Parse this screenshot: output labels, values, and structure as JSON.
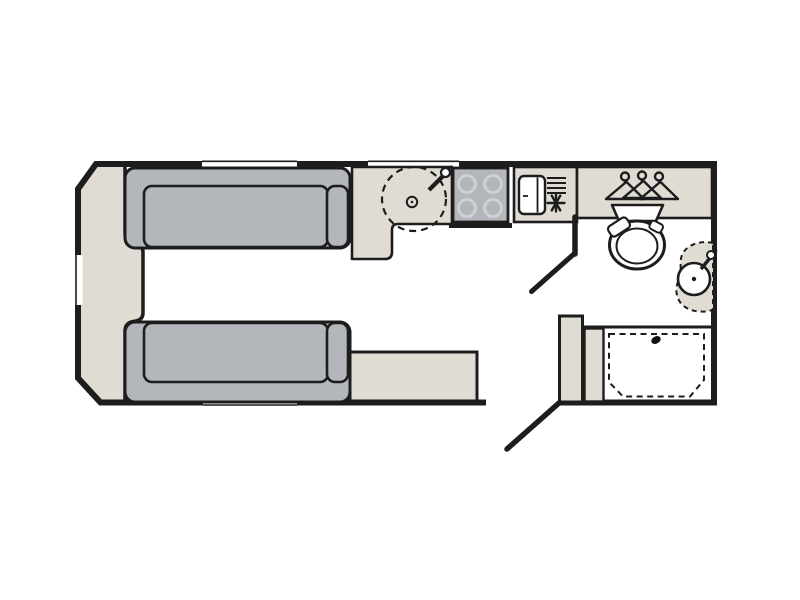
{
  "diagram": {
    "title": "Caravan floor plan, side layout: front lounge with two facing sofas and centre chest, mid kitchen with sink, four-burner hob and fridge, end washroom with wardrobe, toilet, corner basin and shower, entry door at rear kerbside",
    "type": "caravan-floorplan",
    "colors": {
      "wall": "#1d1d1d",
      "upholstery_gray": "#b3b6ba",
      "furniture_beige": "#e0dcd4",
      "floor_white": "#ffffff",
      "burner_ring": "#cdd0d4"
    },
    "fixtures": [
      {
        "icon": "front-chest"
      },
      {
        "icon": "sofa-front-offside"
      },
      {
        "icon": "sofa-front-nearside"
      },
      {
        "icon": "bed-box-extension"
      },
      {
        "icon": "kitchen-worktop"
      },
      {
        "icon": "round-sink-with-tap"
      },
      {
        "icon": "hob-four-burner"
      },
      {
        "icon": "fridge-with-vent-and-snowflake"
      },
      {
        "icon": "wardrobe-with-hangers"
      },
      {
        "icon": "toilet-with-cistern"
      },
      {
        "icon": "corner-washbasin-with-tap"
      },
      {
        "icon": "shower-tray"
      },
      {
        "icon": "entry-door-open"
      },
      {
        "icon": "washroom-door-open"
      },
      {
        "icon": "window-front"
      },
      {
        "icon": "window-offside-lounge"
      },
      {
        "icon": "window-offside-kitchen"
      },
      {
        "icon": "window-nearside-lounge"
      }
    ]
  }
}
